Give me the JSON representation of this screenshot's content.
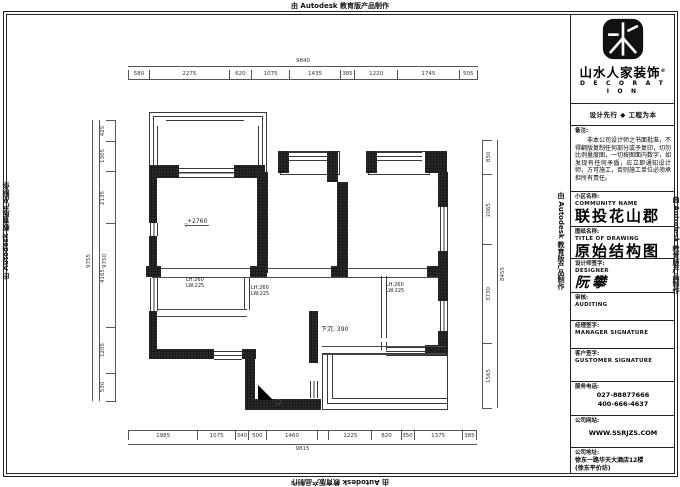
{
  "watermark": "由 Autodesk 教育版产品制作",
  "logo": {
    "brand": "山水人家装饰",
    "reg": "®",
    "brand_en": "D E C O R A T I O N",
    "tagline": "设计先行 ◆ 工程为本"
  },
  "titleblock": {
    "notes_label": "备注:",
    "notes": "非本公司设计师之书面批准，不得翻版复制任何部分或予复印，切勿比例量度图，一切按图面内数字，如发现有任何矛盾，应立即通知设计师，方可施工，否则施工单位必须承担所有责任。",
    "community_label": "小区名称:",
    "community_label_en": "COMMUNITY NAME",
    "community_value": "联投花山郡",
    "drawing_label": "图纸名称:",
    "drawing_label_en": "TITLE OF DRAWING",
    "drawing_value": "原始结构图",
    "designer_label": "设计师签字:",
    "designer_label_en": "DESIGNER",
    "designer_value": "阮攀",
    "audit_label": "审核:",
    "audit_label_en": "AUDITING",
    "manager_label": "经理签字:",
    "manager_label_en": "MANAGER SIGNATURE",
    "customer_label": "客户签字:",
    "customer_label_en": "GUSTOMER SIGNATURE",
    "phone_label": "服务电话:",
    "phone1": "027-88877666",
    "phone2": "400-666-4637",
    "website_label": "公司网站:",
    "website_value": "WWW.SSRJZS.COM",
    "address_label": "公司地址:",
    "address_value": "徐东一路华天大酒店12楼",
    "address_value2": "(徐东平价坊)"
  },
  "plan": {
    "elevation": "+2760",
    "elevation_marker": "▽",
    "sunken": "下沉: 390",
    "beams": [
      {
        "lh": "LH:260",
        "lw": "LW:225"
      },
      {
        "lh": "LH:260",
        "lw": "LW:225"
      },
      {
        "lh": "LH:260",
        "lw": "LW:225"
      }
    ]
  },
  "dims": {
    "top": {
      "overall": "9840",
      "segments": [
        "580",
        "2275",
        "620",
        "1075",
        "1435",
        "385",
        "1220",
        "1745",
        "505"
      ]
    },
    "bottom": {
      "overall": "9815",
      "segments": [
        "1985",
        "1075",
        "340",
        "500",
        "1460",
        "",
        "1225",
        "820",
        "350",
        "1375",
        "385"
      ]
    },
    "left": {
      "overall_outer": "9755",
      "overall_inner": "9750",
      "segments": [
        "425",
        "1305",
        "2135",
        "4165",
        "1205",
        "530"
      ]
    },
    "right": {
      "overall": "8455",
      "segments": [
        "830",
        "2065",
        "3730",
        "1565"
      ]
    }
  }
}
